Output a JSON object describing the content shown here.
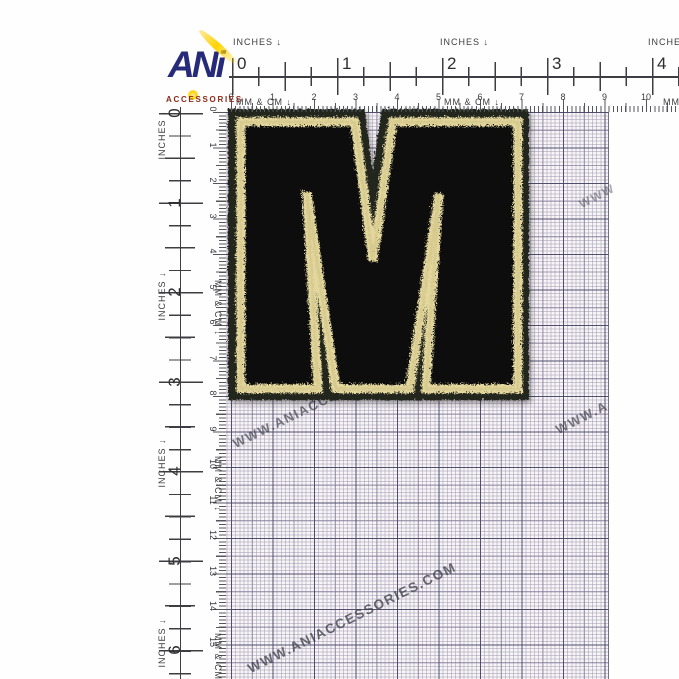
{
  "logo": {
    "brand": "ANi",
    "subtitle": "ACCESSORIES",
    "colors": {
      "navy": "#272a7b",
      "yellow": "#ffd400",
      "red": "#8a2a1a"
    }
  },
  "rulers": {
    "inches_label": "INCHES ↓",
    "mm_cm_label": "MM & CM ↓",
    "top_inches": {
      "numbers": [
        "0",
        "1",
        "2",
        "3",
        "4"
      ]
    },
    "top_cm": {
      "numbers": [
        "0",
        "1",
        "2",
        "3",
        "4",
        "5",
        "6",
        "7",
        "8",
        "9",
        "10"
      ]
    },
    "left_inches": {
      "numbers": [
        "0",
        "1",
        "2",
        "3",
        "4",
        "5",
        "6"
      ]
    },
    "left_cm": {
      "numbers": [
        "0",
        "1",
        "2",
        "3",
        "4",
        "5",
        "6",
        "7",
        "8",
        "9",
        "10",
        "11",
        "12",
        "13",
        "14",
        "15"
      ]
    }
  },
  "patch": {
    "letter": "M",
    "fill_color": "#0d0d0b",
    "outline_color": "#e3d79e",
    "backing_color": "#22251e"
  },
  "watermark": {
    "text": "WWW.ANIACCESSORIES.COM",
    "fragments": [
      {
        "text": "WWW.ANIACCESSORIES.COM",
        "x": 237,
        "y": 452,
        "deg": -26,
        "size": 13,
        "op": 0.8
      },
      {
        "text": "WWW.A",
        "x": 560,
        "y": 438,
        "deg": -27,
        "size": 13,
        "op": 0.8
      },
      {
        "text": "WWW",
        "x": 583,
        "y": 213,
        "deg": -27,
        "size": 12,
        "op": 0.55
      },
      {
        "text": "WWW.ANIACCESSORIES.COM",
        "x": 252,
        "y": 677,
        "deg": -26.5,
        "size": 13.5,
        "op": 0.9
      }
    ]
  },
  "grid": {
    "paper_color": "#f7f5f6",
    "major_line": "#4e4a6a"
  }
}
